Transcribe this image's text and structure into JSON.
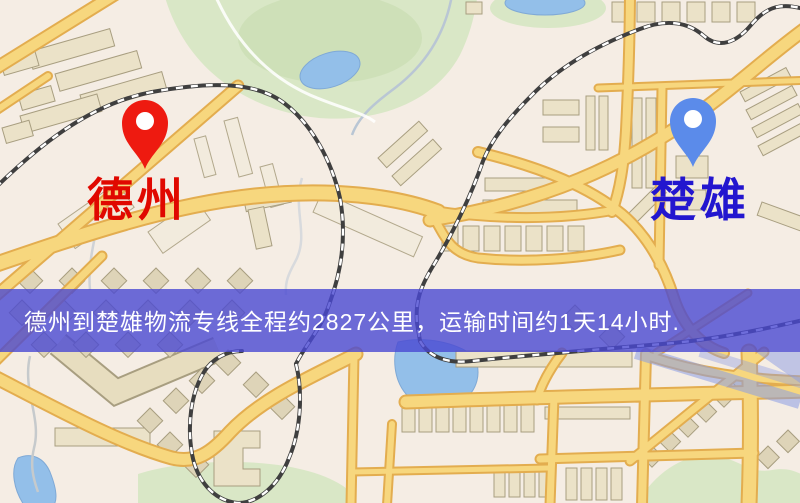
{
  "route_banner": {
    "text": "德州到楚雄物流专线全程约2827公里，运输时间约1天14小时.",
    "background": "rgba(74,72,210,0.8)",
    "text_color": "#ffffff",
    "distance": "2827公里",
    "duration": "1天14小时"
  },
  "origin": {
    "label": "德州",
    "pin_icon": "red-map-pin-icon",
    "pin_color": "#ee1a10",
    "label_color": "#e00800"
  },
  "destination": {
    "label": "楚雄",
    "pin_icon": "blue-map-pin-icon",
    "pin_color": "#5b8bea",
    "label_color": "#2316cf"
  }
}
